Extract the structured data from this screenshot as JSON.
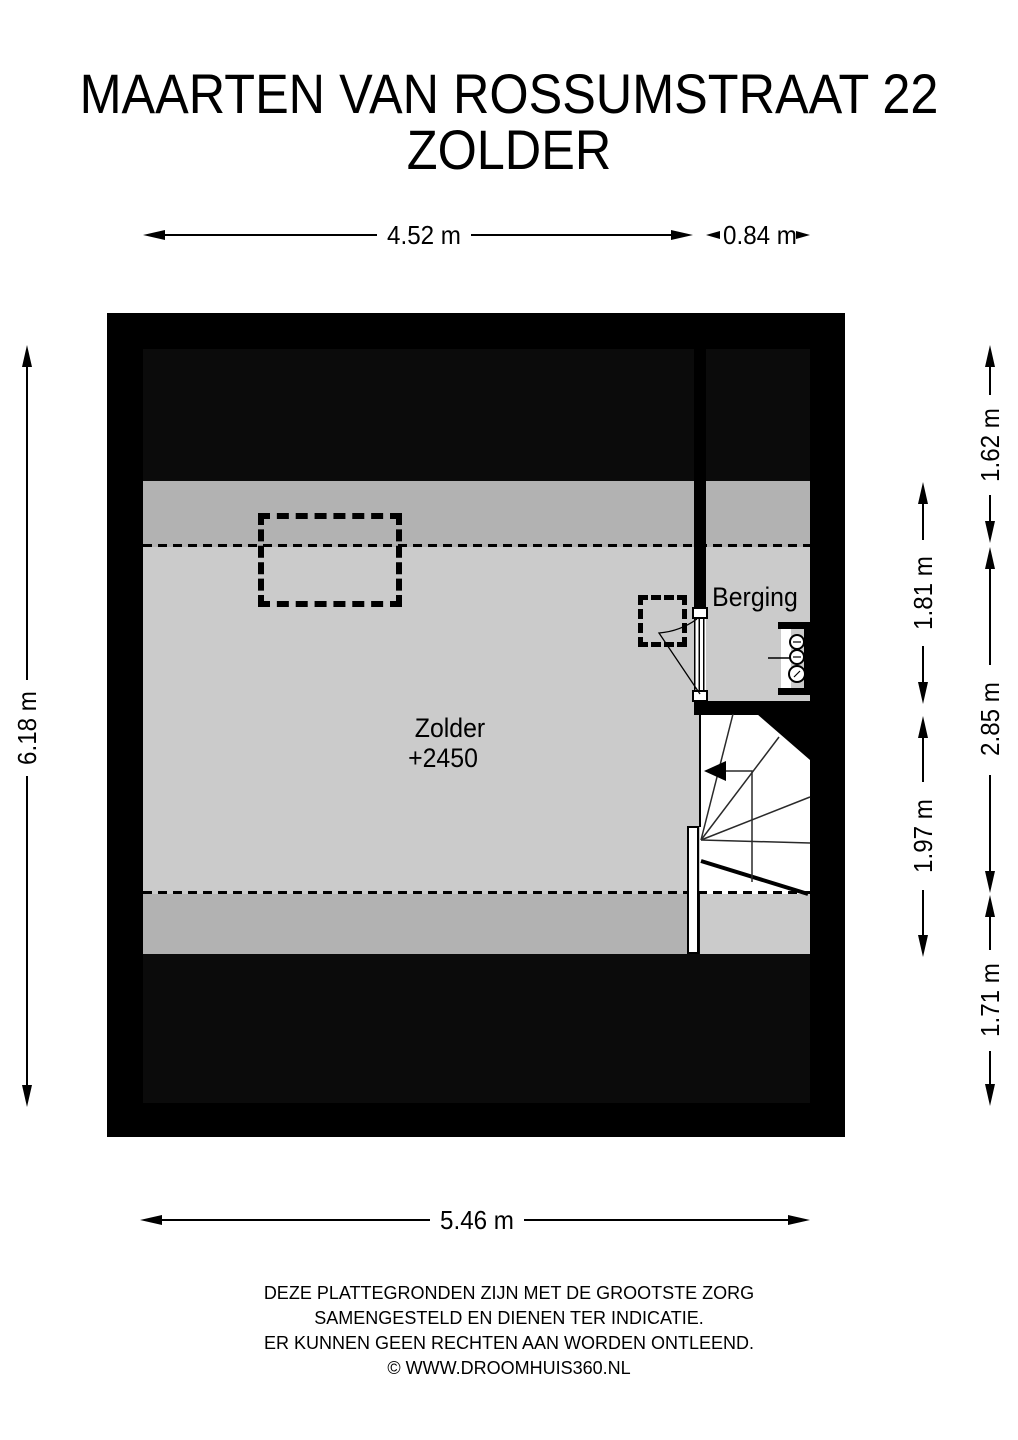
{
  "title": {
    "line1": "MAARTEN VAN ROSSUMSTRAAT 22",
    "line2": "ZOLDER"
  },
  "plan": {
    "rooms": {
      "zolder": {
        "name": "Zolder",
        "level": "+2450"
      },
      "berging": {
        "name": "Berging"
      }
    },
    "features": [
      "dormer-outline-dashed",
      "chimney-outline-dashed",
      "door-with-swing",
      "winder-staircase",
      "boiler-unit"
    ],
    "colors": {
      "wall": "#000000",
      "roof_void": "#0b0b0b",
      "floor_light": "#cbcbcb",
      "floor_low_headroom": "#b2b2b2",
      "stairwell": "#ffffff"
    }
  },
  "dimensions": {
    "top_main": "4.52 m",
    "top_right": "0.84 m",
    "bottom_total": "5.46 m",
    "left_total": "6.18 m",
    "right_top": "1.62 m",
    "right_middle": "2.85 m",
    "right_bottom": "1.71 m",
    "inner_berging": "1.81 m",
    "inner_stairs": "1.97 m"
  },
  "footer": {
    "line1": "DEZE PLATTEGRONDEN ZIJN MET DE GROOTSTE ZORG",
    "line2": "SAMENGESTELD EN DIENEN TER INDICATIE.",
    "line3": "ER KUNNEN GEEN RECHTEN AAN WORDEN ONTLEEND.",
    "line4": "© WWW.DROOMHUIS360.NL"
  }
}
